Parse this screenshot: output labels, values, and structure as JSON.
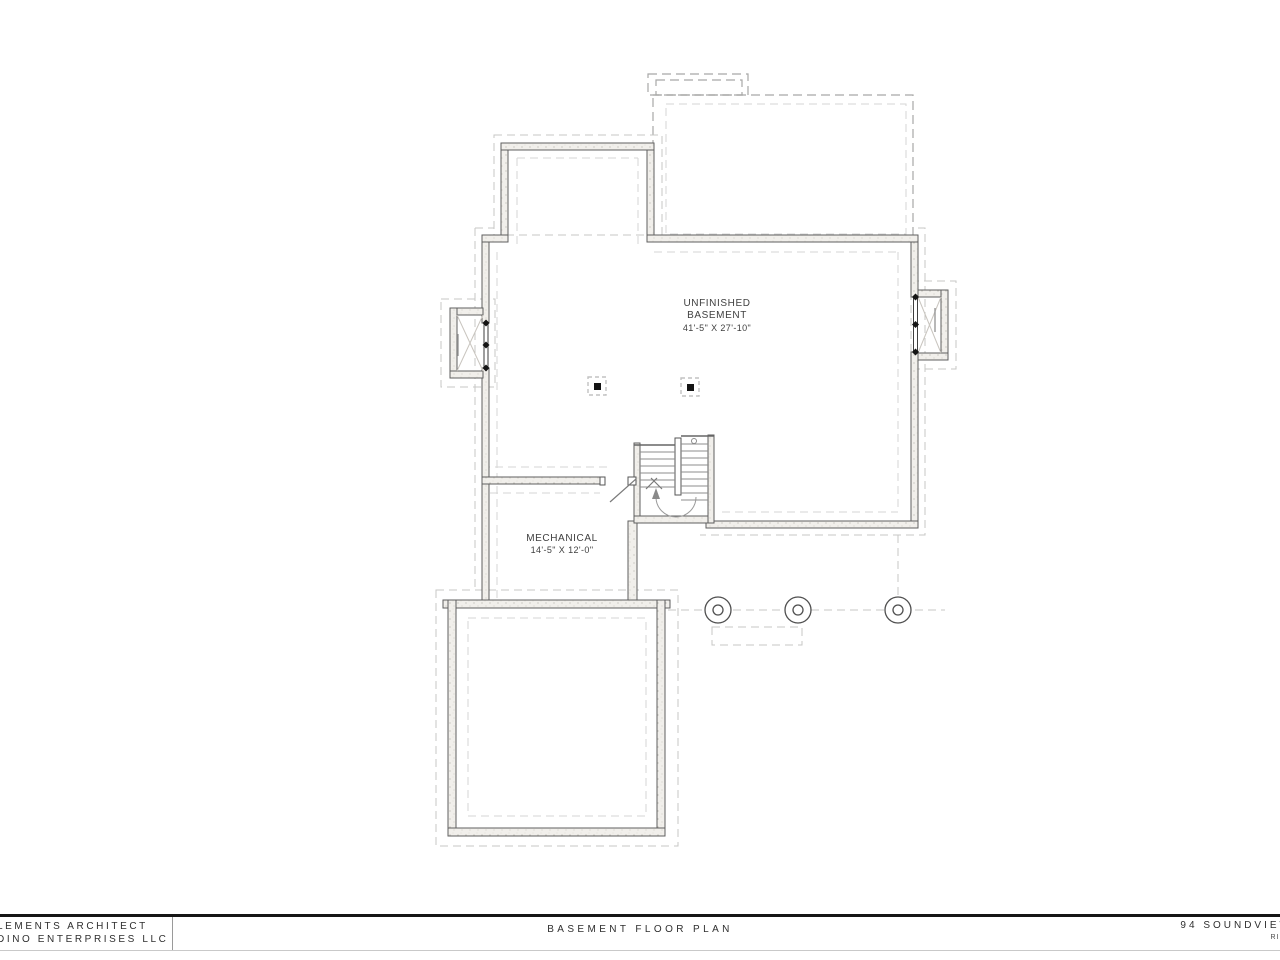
{
  "plan": {
    "unfinished": {
      "line1": "UNFINISHED",
      "line2": "BASEMENT",
      "dims": "41'-5\" X 27'-10\""
    },
    "mechanical": {
      "line1": "MECHANICAL",
      "dims": "14'-5\" X 12'-0\""
    }
  },
  "title_block": {
    "architect_line1": "LEMENTS ARCHITECT",
    "architect_line2": "DINO ENTERPRISES LLC",
    "drawing_title": "BASEMENT FLOOR PLAN",
    "project_line1": "94 SOUNDVIEW",
    "project_line2": "RIDG"
  },
  "colors": {
    "wall_line": "#5f5f5f",
    "wall_fill": "#f1efeb",
    "dashed_footing": "#c7c7c5",
    "dashed_overhead": "#a8a8a6",
    "ink_text": "#3f3f3f",
    "title_rule": "#161616",
    "background": "#ffffff"
  }
}
